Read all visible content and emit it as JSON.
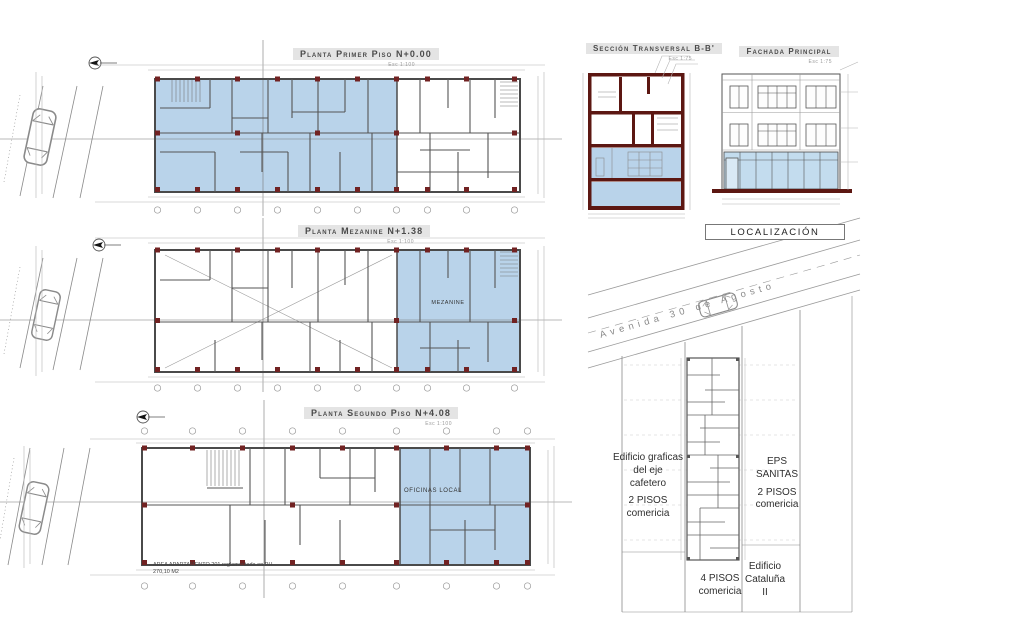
{
  "palette": {
    "plan_fill_blue": "#b9d3ea",
    "structure_maroon": "#5c1712",
    "column_red": "#712222"
  },
  "plans": [
    {
      "title": "Planta Primer Piso N+0.00",
      "scale": "Esc 1:100"
    },
    {
      "title": "Planta Mezanine N+1.38",
      "scale": "Esc 1:100",
      "room_label": "MEZANINE"
    },
    {
      "title": "Planta Segundo Piso N+4.08",
      "scale": "Esc 1:100",
      "room_label": "OFICINAS LOCAL"
    }
  ],
  "area_note": {
    "line1": "AREA APARTAMENTO 201 reglamentada en PH",
    "line2": "270,10 M2"
  },
  "section": {
    "title": "Sección Transversal B-B'",
    "scale": "Esc 1:75"
  },
  "facade": {
    "title": "Fachada Principal",
    "scale": "Esc 1:75"
  },
  "localization": {
    "title": "LOCALIZACIÓN",
    "avenue_label": "Avenida 30 de Agosto",
    "parcel_left": {
      "line1": "Edificio graficas",
      "line2": "del eje",
      "line3": "cafetero",
      "line4": "2 PISOS",
      "line5": "comericia"
    },
    "parcel_right": {
      "line1": "EPS",
      "line2": "SANITAS",
      "line3": "2 PISOS",
      "line4": "comericia"
    },
    "parcel_bottom": {
      "line1": "4 PISOS",
      "line2": "comericia"
    },
    "parcel_corner": {
      "line1": "Edificio",
      "line2": "Cataluña",
      "line3": "II"
    }
  }
}
